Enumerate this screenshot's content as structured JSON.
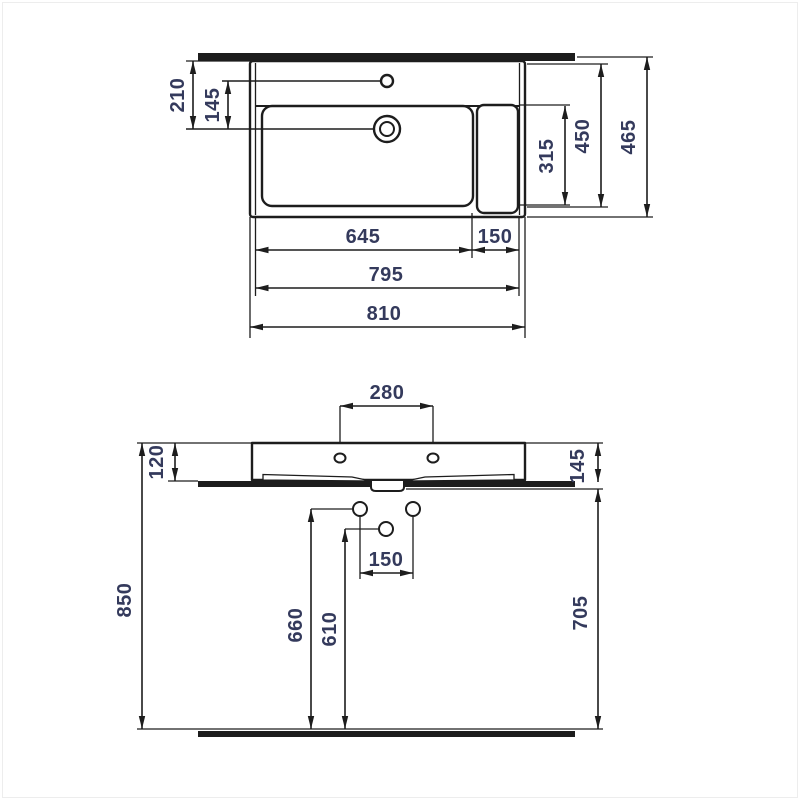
{
  "drawing": {
    "type": "washbasin-dimension-drawing",
    "colors": {
      "line": "#1d1d1d",
      "dimension_text": "#343a5c",
      "background": "#ffffff"
    },
    "top_view": {
      "labels": {
        "d210": "210",
        "d145": "145",
        "d315": "315",
        "d450": "450",
        "d465": "465",
        "d645": "645",
        "d150": "150",
        "d795": "795",
        "d810": "810"
      }
    },
    "front_view": {
      "labels": {
        "d280": "280",
        "d120": "120",
        "d145": "145",
        "d150": "150",
        "d850": "850",
        "d660": "660",
        "d610": "610",
        "d705": "705"
      }
    }
  }
}
